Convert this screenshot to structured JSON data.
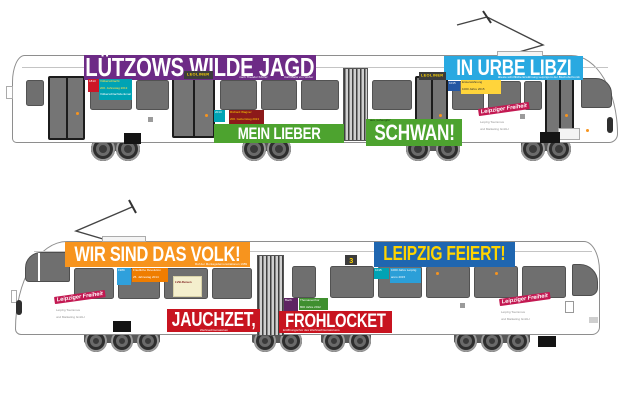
{
  "page": {
    "background": "#ffffff"
  },
  "colors": {
    "purple": "#6d2b86",
    "light_blue": "#29a9e1",
    "green": "#4da32f",
    "orange": "#f7941e",
    "dark_blue": "#1f66b0",
    "red": "#c81420",
    "teal": "#00a3b4",
    "yellow_box": "#ffd43b",
    "dark_red": "#8c1a1a",
    "magenta_stamp": "#c31952",
    "banner_yellow_text": "#ffd400"
  },
  "tram_top": {
    "banner_jagd": {
      "text": "LÜTZOWS WILDE JAGD",
      "sub1": "nach Theodor Körner",
      "sub2": "Carl Maria von Weber"
    },
    "banner_urbe": {
      "text": "IN URBE LIBZI",
      "sub": "älteste schriftliche Erwähnung Leipzigs in der Bischofschronik"
    },
    "banner_mein": {
      "text": "MEIN LIEBER"
    },
    "banner_schwan": {
      "text": "SCHWAN!",
      "note": "aus „Lohengrin“"
    },
    "badge_leoliner": "LEOLINER",
    "tag_red": "1813",
    "info_teal": {
      "l1": "Völkerschlacht",
      "l2": "200. Jahrestag 2013",
      "l3": "Völkerschlachtdenkmal",
      "l4": "100. Jahrestag 2013"
    },
    "tag_teal": "2013",
    "info_wagner": {
      "l1": "Richard Wagner",
      "l2": "200. Geburtstag 2013"
    },
    "tag_blue": "1015",
    "info_yellow": {
      "l1": "Ersterwähnung",
      "l2": "1000 Jahre 2015"
    }
  },
  "tram_bottom": {
    "banner_volk": {
      "text": "WIR SIND DAS VOLK!",
      "sub": "Ruf der Montagsdemonstrationen 1989"
    },
    "banner_feiert": {
      "text": "LEIPZIG FEIERT!"
    },
    "banner_jauchzet": {
      "text": "JAUCHZET,",
      "sub": "Weihnachtsoratorium"
    },
    "banner_frohlocket": {
      "text": "FROHLOCKET",
      "sub": "Eröffnungschor des Weihnachtsoratoriums"
    },
    "line_badge": "3",
    "tag_blue": "1989",
    "info_revolution": {
      "l1": "Friedliche Revolution",
      "l2": "25. Jahrestag 2014"
    },
    "tag_teal": "1015",
    "info_jahre": {
      "l1": "1000 Jahre Leipzig",
      "l2": "anno 2015"
    },
    "box_cream": "LVB-Reisen",
    "tag_purple": "Bach",
    "info_thomaner": {
      "l1": "Thomanerchor",
      "l2": "800 Jahre 2012"
    }
  },
  "stamp": {
    "brand": "Leipziger Freiheit",
    "sub1": "Leipzig Tourismus",
    "sub2": "und Marketing GmbH"
  }
}
